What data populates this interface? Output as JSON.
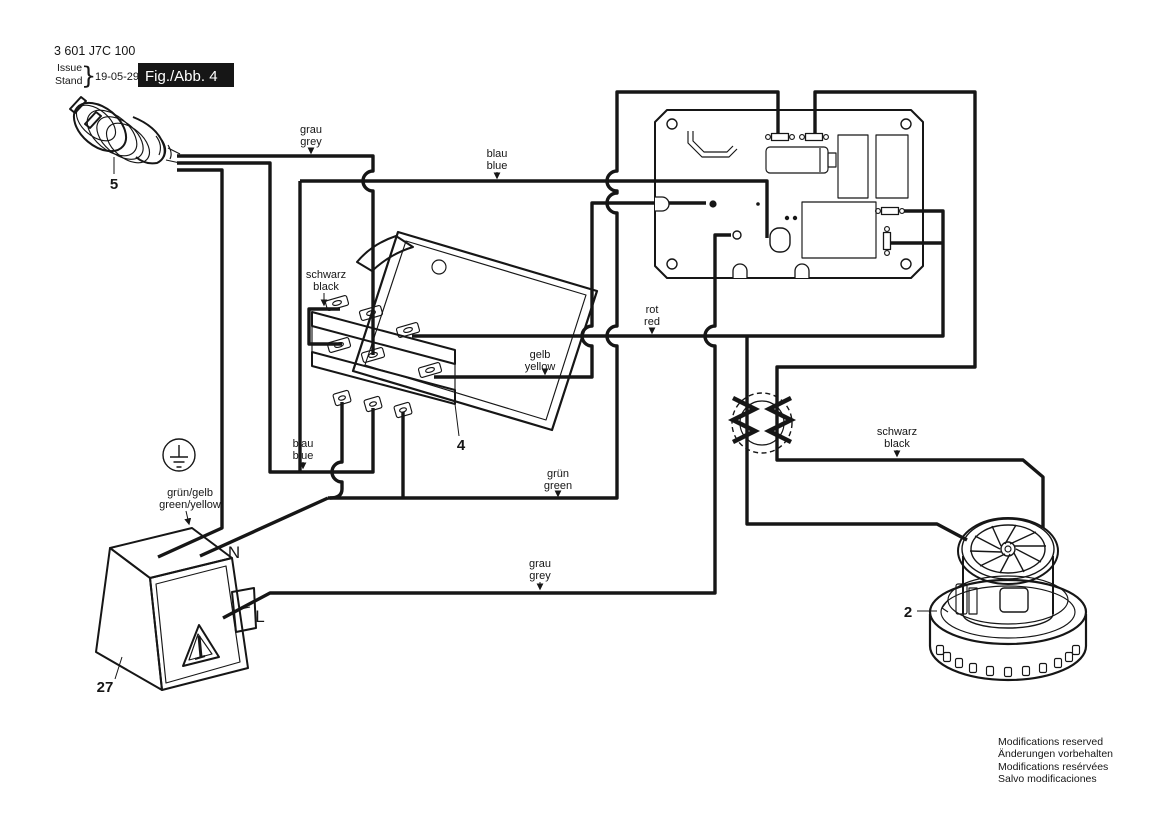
{
  "title_block": {
    "part_number": "3 601 J7C 100",
    "issue": "Issue",
    "stand": "Stand",
    "brace": "}",
    "date": "19-05-29",
    "figure": "Fig./Abb. 4"
  },
  "callouts": {
    "plug": "5",
    "switch": "4",
    "motor": "2",
    "socket": "27",
    "neutral": "N",
    "line": "L"
  },
  "wire_labels": {
    "grau_top": {
      "l1": "grau",
      "l2": "grey"
    },
    "blau_top": {
      "l1": "blau",
      "l2": "blue"
    },
    "schwarz_switch": {
      "l1": "schwarz",
      "l2": "black"
    },
    "gelb": {
      "l1": "gelb",
      "l2": "yellow"
    },
    "rot": {
      "l1": "rot",
      "l2": "red"
    },
    "blau_bottom": {
      "l1": "blau",
      "l2": "blue"
    },
    "gruen": {
      "l1": "grün",
      "l2": "green"
    },
    "gruen_gelb": {
      "l1": "grün/gelb",
      "l2": "green/yellow"
    },
    "schwarz_motor": {
      "l1": "schwarz",
      "l2": "black"
    },
    "grau_bottom": {
      "l1": "grau",
      "l2": "grey"
    }
  },
  "footer": {
    "line1": "Modifications reserved",
    "line2": "Änderungen vorbehalten",
    "line3": "Modifications resérvées",
    "line4": "Salvo modificaciones"
  },
  "colors": {
    "ink": "#161616",
    "paper": "#ffffff"
  }
}
